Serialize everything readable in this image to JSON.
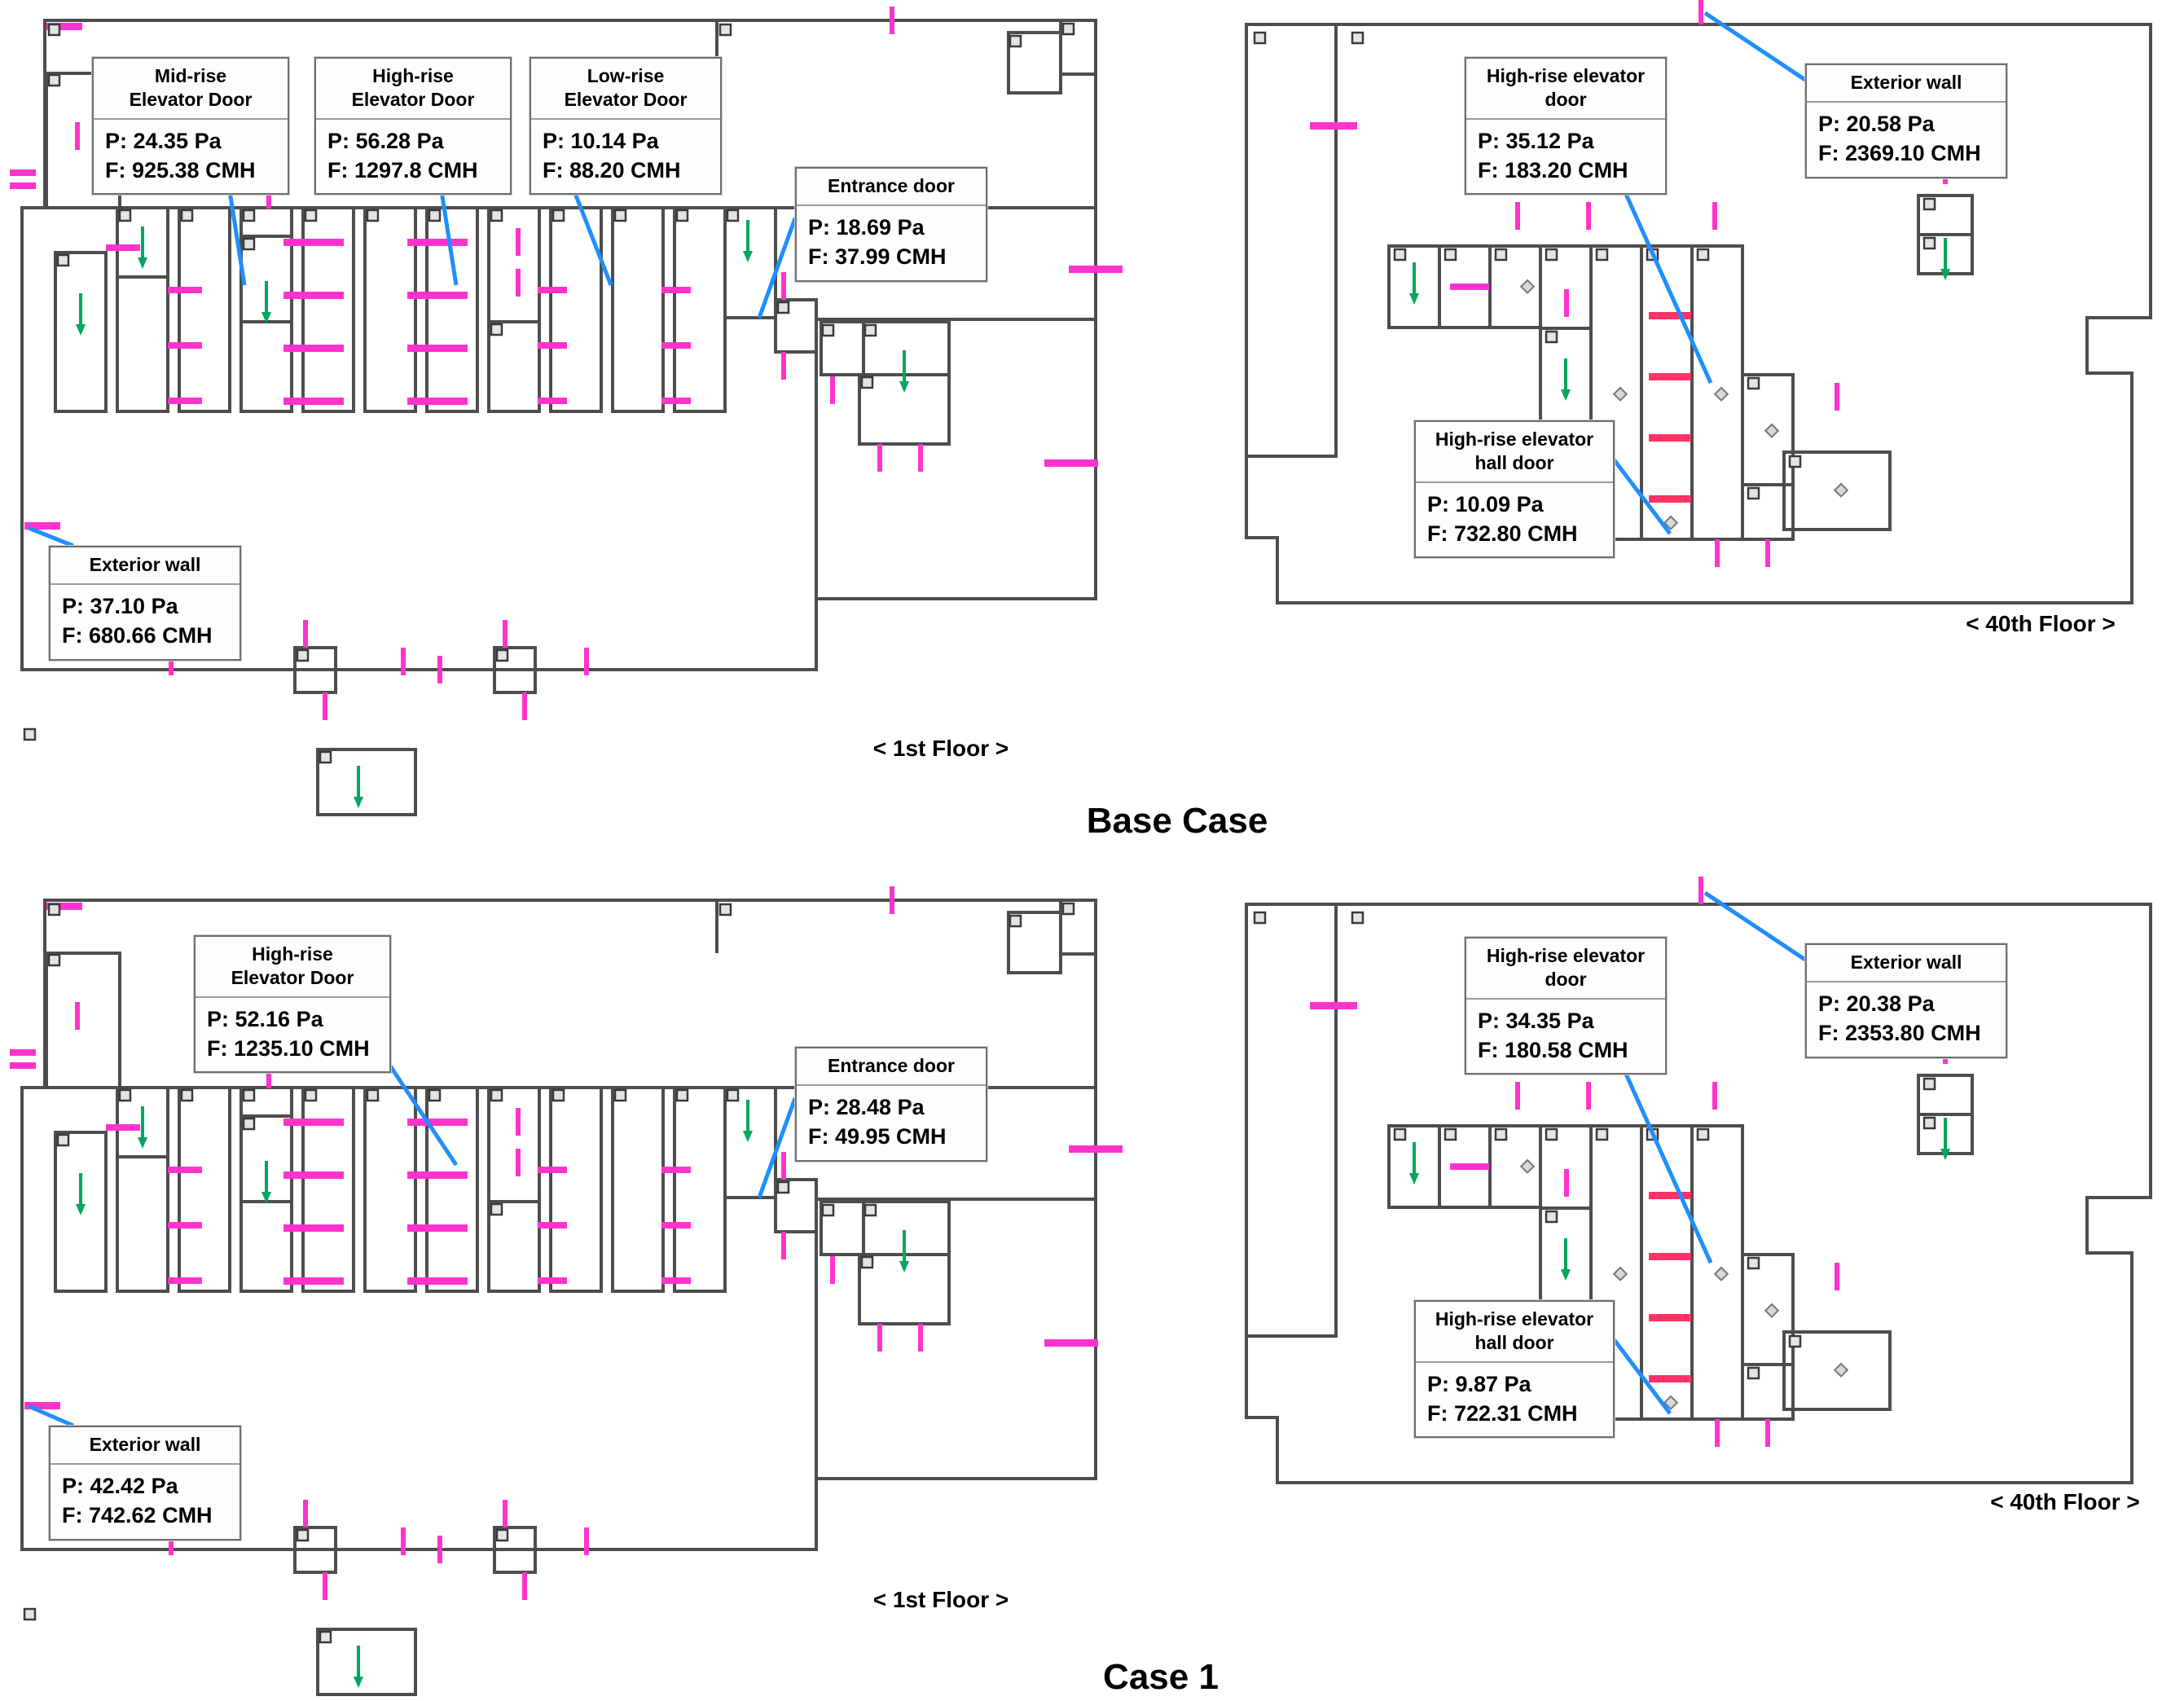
{
  "titles": {
    "base": "Base Case",
    "case1": "Case 1"
  },
  "labels": {
    "first_floor": "< 1st Floor >",
    "fortieth_floor": "< 40th Floor >"
  },
  "callouts": {
    "b_mid": {
      "t1": "Mid-rise",
      "t2": "Elevator Door",
      "p": "P: 24.35 Pa",
      "f": "F: 925.38 CMH"
    },
    "b_high": {
      "t1": "High-rise",
      "t2": "Elevator Door",
      "p": "P: 56.28 Pa",
      "f": "F: 1297.8 CMH"
    },
    "b_low": {
      "t1": "Low-rise",
      "t2": "Elevator Door",
      "p": "P: 10.14 Pa",
      "f": "F: 88.20 CMH"
    },
    "b_entrance": {
      "t1": "Entrance door",
      "t2": "",
      "p": "P: 18.69 Pa",
      "f": "F: 37.99 CMH"
    },
    "b_exterior": {
      "t1": "Exterior wall",
      "t2": "",
      "p": "P: 37.10 Pa",
      "f": "F: 680.66 CMH"
    },
    "b40_door": {
      "t1": "High-rise elevator",
      "t2": "door",
      "p": "P: 35.12 Pa",
      "f": "F: 183.20 CMH"
    },
    "b40_ext": {
      "t1": "Exterior wall",
      "t2": "",
      "p": "P: 20.58 Pa",
      "f": "F: 2369.10 CMH"
    },
    "b40_hall": {
      "t1": "High-rise elevator",
      "t2": "hall door",
      "p": "P: 10.09 Pa",
      "f": "F: 732.80 CMH"
    },
    "c_high": {
      "t1": "High-rise",
      "t2": "Elevator Door",
      "p": "P: 52.16 Pa",
      "f": "F: 1235.10 CMH"
    },
    "c_entrance": {
      "t1": "Entrance door",
      "t2": "",
      "p": "P: 28.48 Pa",
      "f": "F: 49.95 CMH"
    },
    "c_exterior": {
      "t1": "Exterior wall",
      "t2": "",
      "p": "P: 42.42 Pa",
      "f": "F: 742.62 CMH"
    },
    "c40_door": {
      "t1": "High-rise elevator",
      "t2": "door",
      "p": "P: 34.35 Pa",
      "f": "F: 180.58 CMH"
    },
    "c40_ext": {
      "t1": "Exterior wall",
      "t2": "",
      "p": "P: 20.38 Pa",
      "f": "F: 2353.80 CMH"
    },
    "c40_hall": {
      "t1": "High-rise elevator",
      "t2": "hall door",
      "p": "P: 9.87 Pa",
      "f": "F: 722.31 CMH"
    }
  },
  "colors": {
    "wall": "#4d4d4d",
    "shaft_orange": "#fadcc3",
    "shaft_green": "#d7e9c8",
    "shaft_pink": "#f6d4f2",
    "shaft_yellow": "#f8f5b4",
    "shaft_cyan": "#e1f0f2",
    "room_gray": "#efefef",
    "flow_magenta": "#ff33cc",
    "flow_red": "#ff3366",
    "arrow_green": "#00a75c",
    "leader_blue": "#1e8fff"
  }
}
